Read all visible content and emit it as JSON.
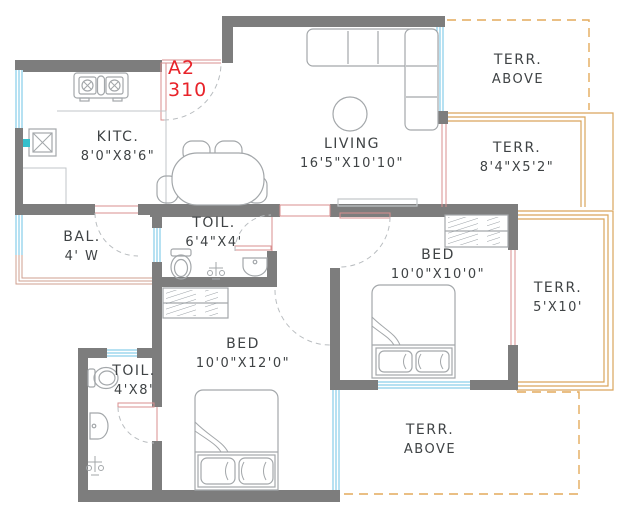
{
  "plan": {
    "unit": {
      "label": "A2",
      "number": "310"
    },
    "rooms": {
      "kitchen": {
        "line1": "KITC.",
        "line2": "8'0\"X8'6\""
      },
      "living": {
        "line1": "LIVING",
        "line2": "16'5\"X10'10\""
      },
      "balcony": {
        "line1": "BAL.",
        "line2": "4' W"
      },
      "toilet_common": {
        "line1": "TOIL.",
        "line2": "6'4\"X4'"
      },
      "toilet_attached": {
        "line1": "TOIL.",
        "line2": "4'X8'"
      },
      "bed_master": {
        "line1": "BED",
        "line2": "10'0\"X12'0\""
      },
      "bed_second": {
        "line1": "BED",
        "line2": "10'0\"X10'0\""
      },
      "terrace_right": {
        "line1": "TERR.",
        "line2": "8'4\"X5'2\""
      },
      "terrace_side": {
        "line1": "TERR.",
        "line2": "5'X10'"
      },
      "terrace_above_top": {
        "line1": "TERR.",
        "line2": "ABOVE"
      },
      "terrace_above_bottom": {
        "line1": "TERR.",
        "line2": "ABOVE"
      }
    },
    "colors": {
      "wall": "#7d7d7d",
      "window": "#6ec3e6",
      "terrace_border": "#d9a55c",
      "terrace_dashed": "#e3aa5c",
      "balcony_border": "#cf9f8f",
      "opening": "#d98f8f",
      "furniture": "#a3a7aa",
      "label_text": "#3f4345",
      "unit_text": "#e8232a",
      "faucet_accent": "#35c0cc"
    }
  }
}
